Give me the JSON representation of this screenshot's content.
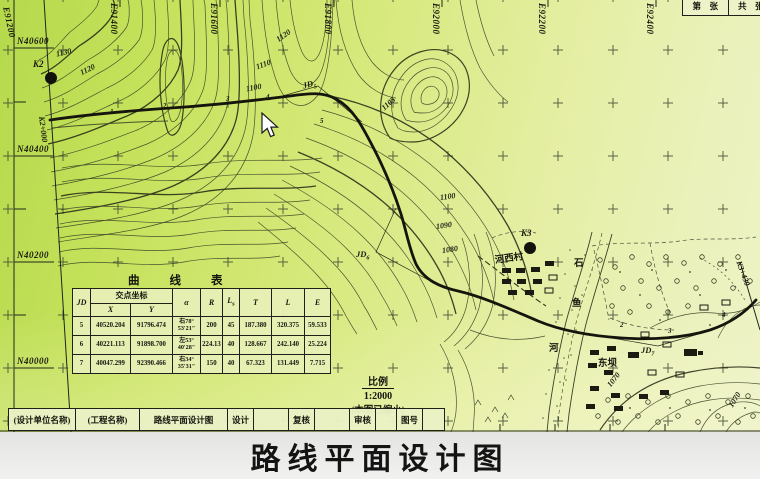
{
  "map": {
    "grid": {
      "top_labels": [
        "E91200",
        "E91400",
        "E91600",
        "E91800",
        "E92000",
        "E92200",
        "E92400"
      ],
      "left_labels": [
        "N40600",
        "N40400",
        "N40200",
        "N40000"
      ]
    },
    "sheet_box": {
      "cell1": "第　张",
      "cell2": "共　张"
    },
    "stations": {
      "k2": "K2",
      "k2_start": "K2+000",
      "k3": "K3",
      "k3_end": "K3+430"
    },
    "jd_points": [
      {
        "prefix": "JD",
        "sub": "5"
      },
      {
        "prefix": "JD",
        "sub": "6"
      },
      {
        "prefix": "JD",
        "sub": "7"
      }
    ],
    "contour_labels": [
      "1130",
      "1120",
      "1120",
      "1110",
      "1100",
      "1105",
      "1100",
      "1090",
      "1080",
      "1070",
      "1070"
    ],
    "stakes_left": [
      "1",
      "2",
      "3",
      "4",
      "5"
    ],
    "stakes_right": [
      "2",
      "3",
      "4"
    ],
    "places": {
      "village1": "河西村",
      "village2": "东坝",
      "river_char1": "石",
      "river_char2": "鱼",
      "river_char3": "河"
    }
  },
  "curve_table": {
    "title": "曲线表",
    "headers": {
      "jd": "JD",
      "coord": "交点坐标",
      "x": "X",
      "y": "Y",
      "alpha": "α",
      "r": "R",
      "ls_main": "L",
      "ls_sub": "s",
      "t": "T",
      "l": "L",
      "e": "E"
    },
    "rows": [
      {
        "jd": "5",
        "x": "40520.204",
        "y": "91796.474",
        "a1": "右78°",
        "a2": "53′21″",
        "r": "200",
        "ls": "45",
        "t": "187.380",
        "l": "320.375",
        "e": "59.533"
      },
      {
        "jd": "6",
        "x": "40221.113",
        "y": "91898.700",
        "a1": "左53°",
        "a2": "40′28″",
        "r": "224.13",
        "ls": "40",
        "t": "128.667",
        "l": "242.140",
        "e": "25.224"
      },
      {
        "jd": "7",
        "x": "40047.299",
        "y": "92390.466",
        "a1": "右34°",
        "a2": "35′31″",
        "r": "150",
        "ls": "40",
        "t": "67.323",
        "l": "131.449",
        "e": "7.715"
      }
    ]
  },
  "scale_note": {
    "label": "比例",
    "ratio": "1:2000",
    "note": "(本图已缩小)"
  },
  "title_block": {
    "cells": [
      "(设计单位名称)",
      "(工程名称)",
      "路线平面设计图",
      "设计",
      "",
      "复核",
      "",
      "审核",
      "",
      "图号",
      ""
    ]
  },
  "caption": "路线平面设计图"
}
